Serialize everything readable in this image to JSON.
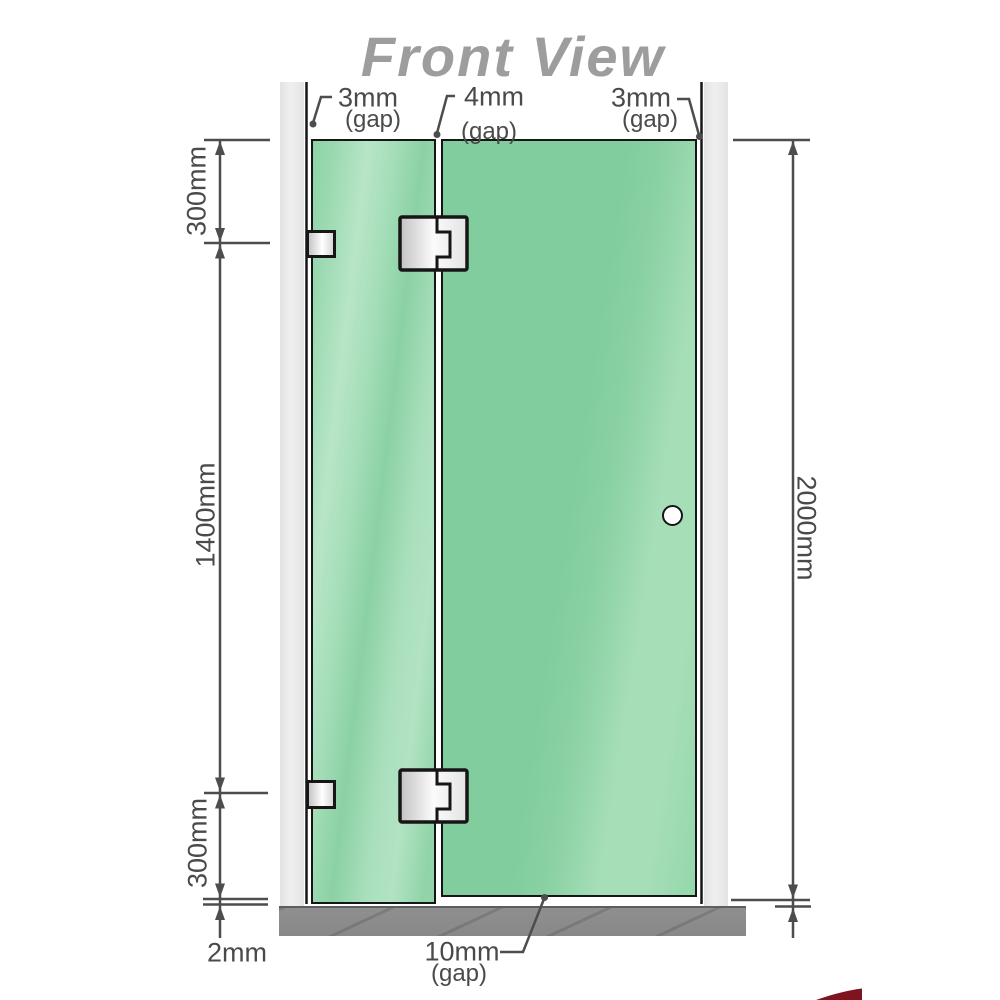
{
  "title": "Front View",
  "annotations": {
    "gap_top_left": {
      "value": "3mm",
      "qualifier": "(gap)"
    },
    "gap_top_middle": {
      "value": "4mm",
      "qualifier": "(gap)"
    },
    "gap_top_right": {
      "value": "3mm",
      "qualifier": "(gap)"
    },
    "gap_bottom": {
      "value": "10mm",
      "qualifier": "(gap)"
    },
    "dim_top_left_segment": "300mm",
    "dim_middle_left_segment": "1400mm",
    "dim_bottom_left_segment": "300mm",
    "dim_floor_clearance": "2mm",
    "dim_total_height": "2000mm"
  },
  "colors": {
    "glass_green": "#86cfa1",
    "glass_highlight": "#b4e4c5",
    "wall_channel_gray": "#e8e8e8",
    "floor_gray": "#8e8e8e",
    "dimension_line_gray": "#4d4d4d",
    "title_gray": "#9d9d9d",
    "hardware_white": "#f8f8f8",
    "outline_black": "#161616",
    "logo_red": "#7e1322"
  }
}
